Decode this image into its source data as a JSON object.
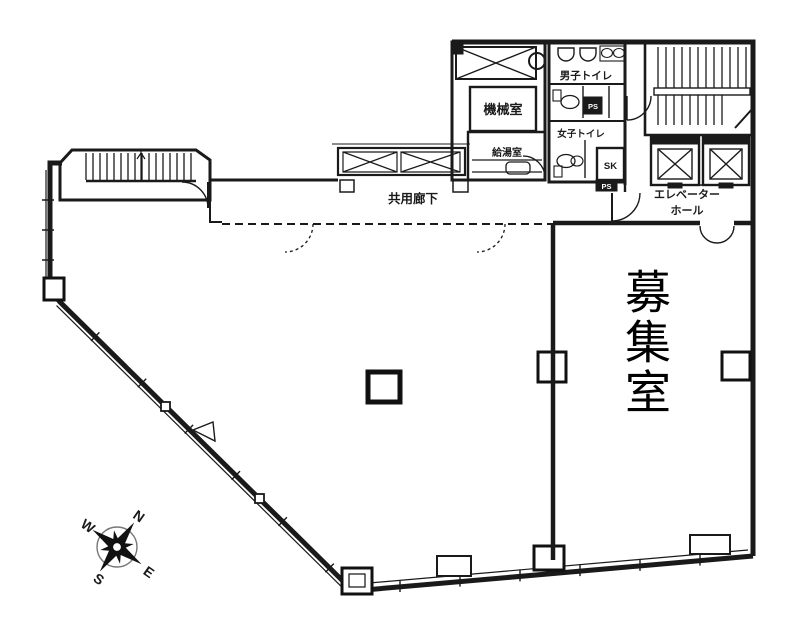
{
  "plan": {
    "vacancy_room": "募集室",
    "rooms": {
      "machine_room": "機械室",
      "mens_toilet": "男子トイレ",
      "womens_toilet": "女子トイレ",
      "kitchenette": "給湯室",
      "common_corridor": "共用廊下",
      "elevator_hall_line1": "エレベーター",
      "elevator_hall_line2": "ホール",
      "sk_sink": "SK",
      "pipe_shaft_upper": "PS",
      "pipe_shaft_lower": "PS"
    },
    "compass": {
      "north": "N",
      "east": "E",
      "south": "S",
      "west": "W"
    },
    "colors": {
      "ink": "#1a1a1a",
      "paper": "#ffffff"
    }
  }
}
